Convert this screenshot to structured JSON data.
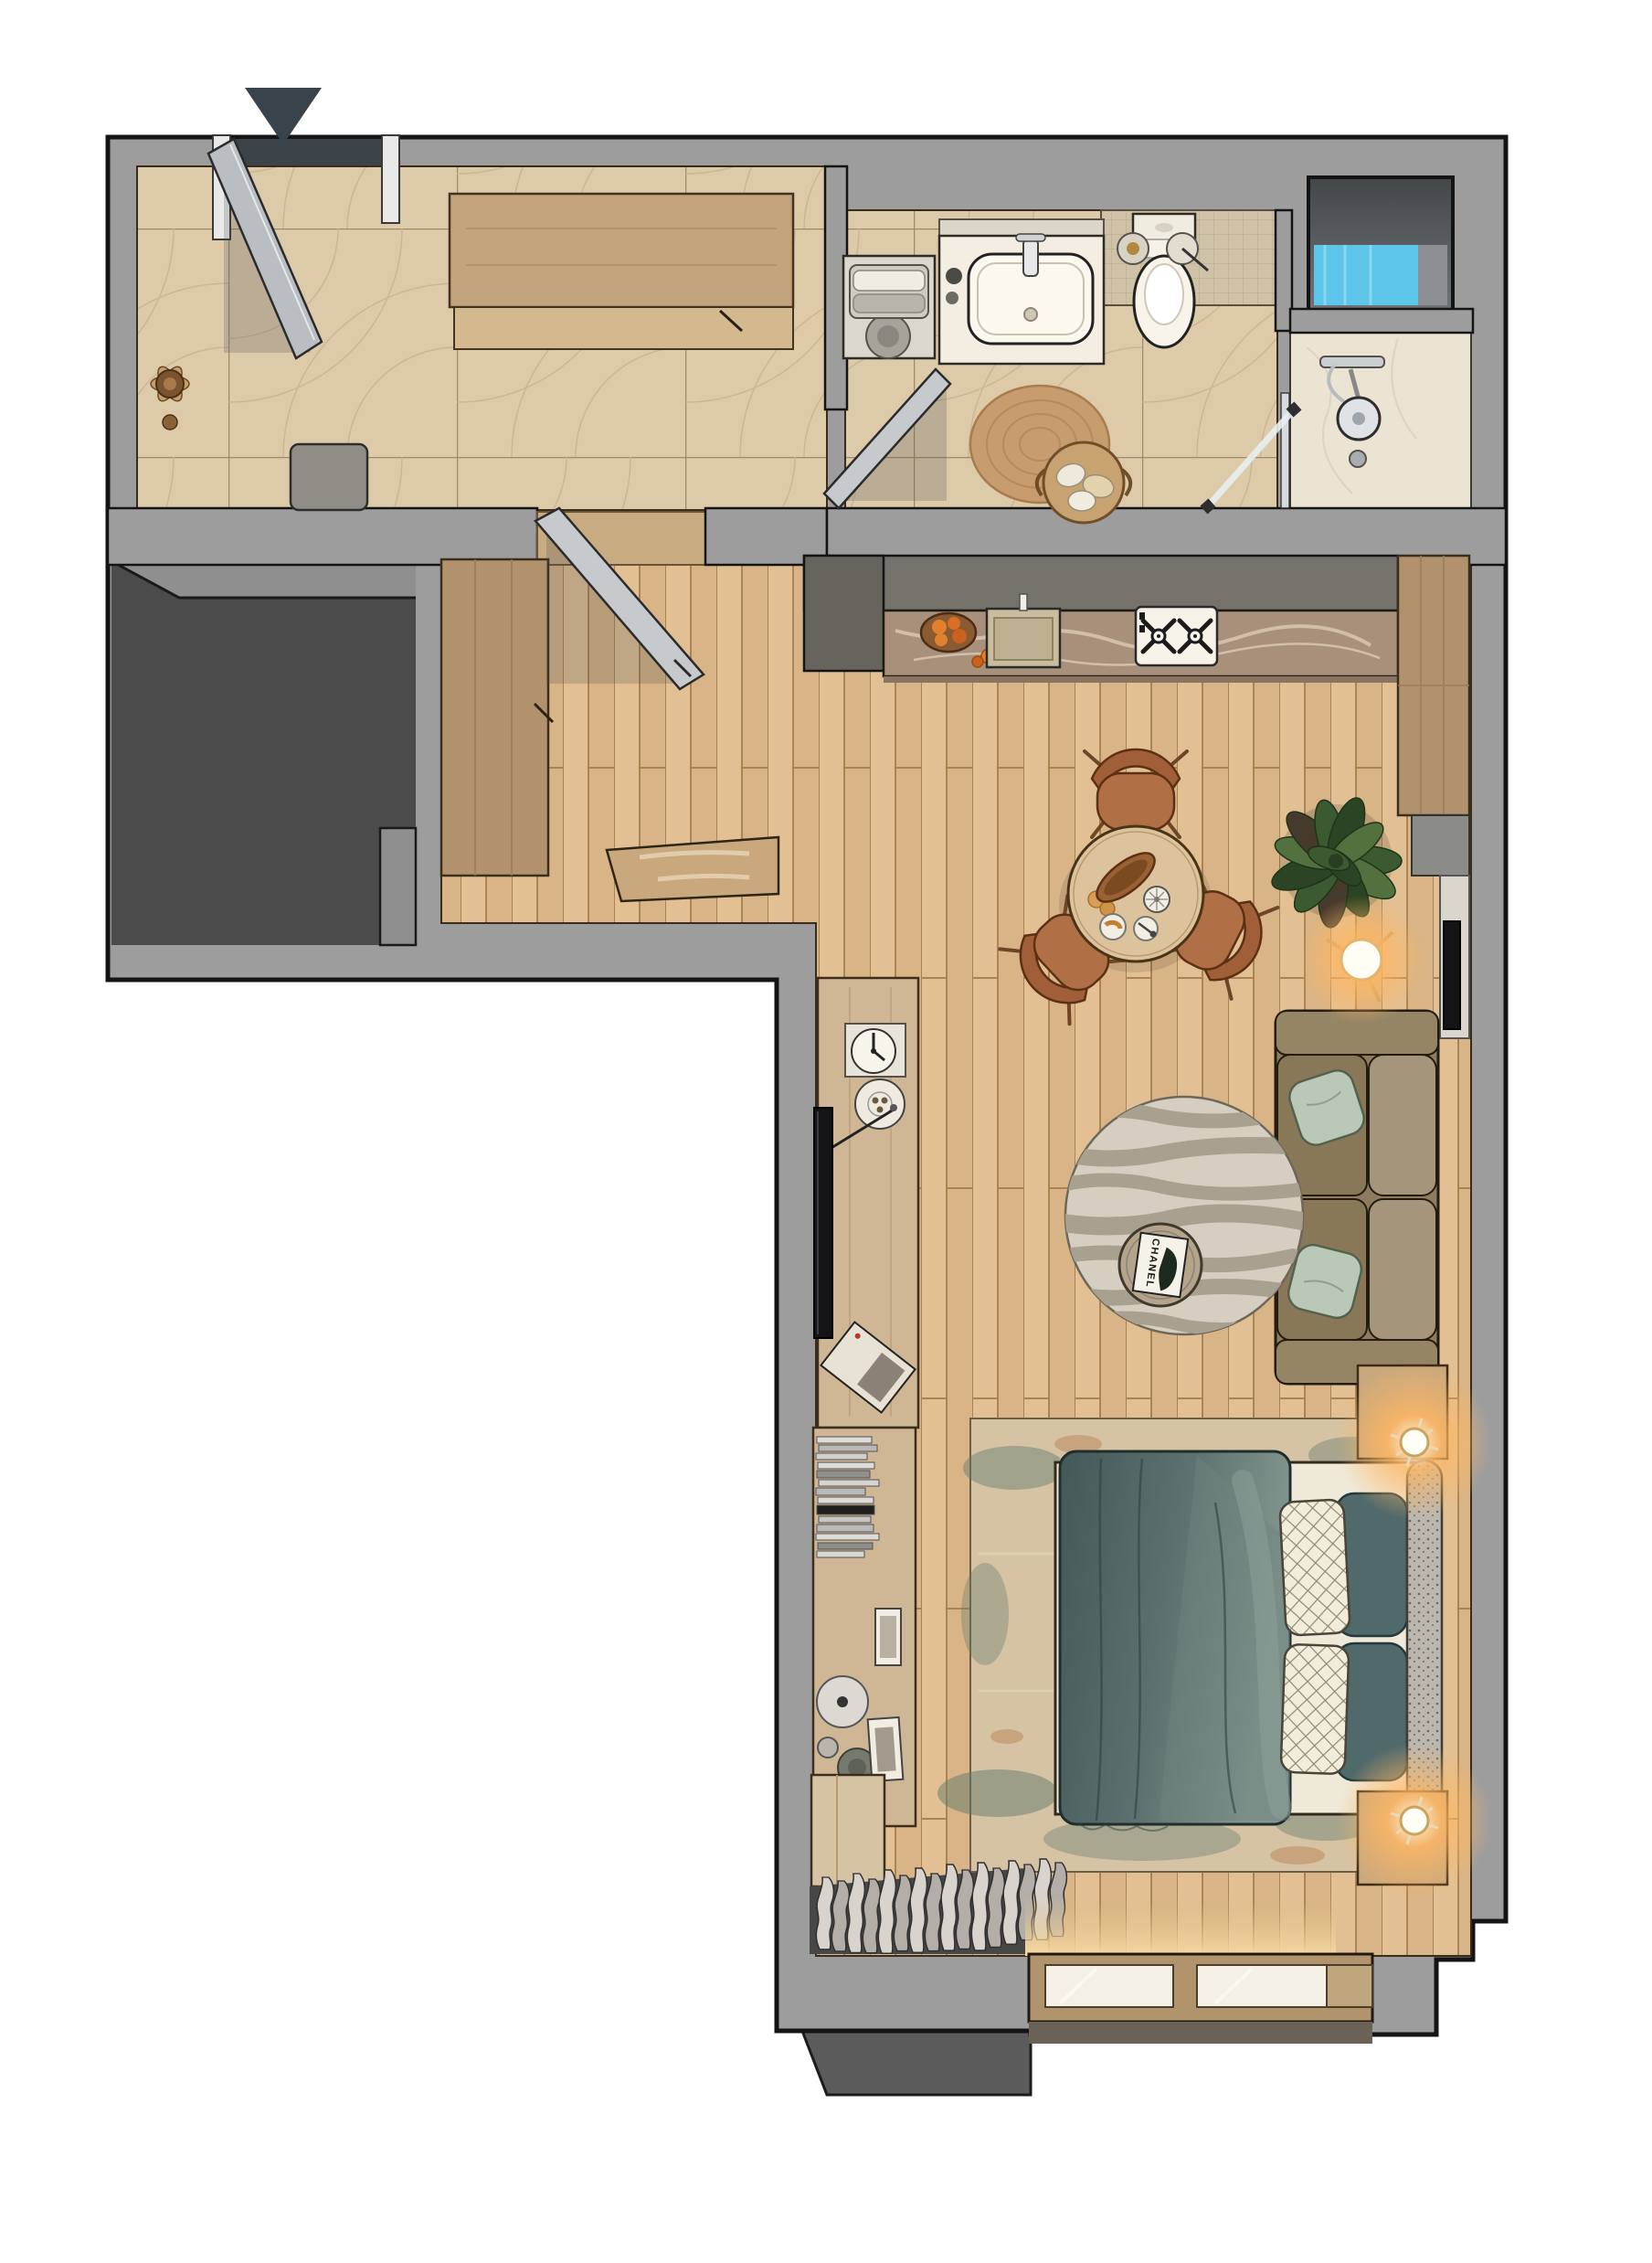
{
  "meta": {
    "view": "top-down 3d rendered floor plan",
    "apartment_shape": "L-shaped studio"
  },
  "entrance": {
    "marker": "entry-direction-arrow"
  },
  "rooms": {
    "entry_hall": {
      "floor": "beige fan-mosaic tile",
      "items": [
        "entry-door",
        "door-frame",
        "wardrobe-cabinet",
        "bench-pouf",
        "wood-wall-decor",
        "hall-door-to-corridor"
      ]
    },
    "bathroom": {
      "floor": "beige fan-mosaic tile",
      "items": [
        "washing-machine",
        "towel-stack",
        "sink-vanity",
        "faucet",
        "toilet",
        "wall-accessories",
        "jute-round-rug",
        "towel-basket",
        "bathroom-door",
        "glass-shower-door"
      ]
    },
    "shower_room": {
      "floor": "cream marble",
      "items": [
        "shower-head",
        "shower-mixer",
        "floor-drain",
        "window-niche-blue-glass"
      ]
    },
    "kitchen": {
      "items": [
        "upper-cabinet-band",
        "stone-countertop",
        "fruit-bowl",
        "counter-sink",
        "gas-hob-two-burners",
        "tall-cabinet-column",
        "wall-niche",
        "wall-shelf",
        "wall-tv-panel",
        "glossy-doormat",
        "corridor-cabinet"
      ]
    },
    "living": {
      "coffee_table_book_title": "CHANEL",
      "items": [
        "round-dining-table",
        "dining-chair",
        "bread-basket",
        "cake-stand",
        "plates",
        "rubber-plant",
        "floor-lamp",
        "sofa",
        "mint-pillows",
        "zebra-round-rug",
        "coffee-table",
        "tv-console",
        "wall-clock",
        "deco-plate",
        "wall-tv",
        "magazine"
      ]
    },
    "bedroom": {
      "items": [
        "bookshelf",
        "book-stack",
        "picture-frames",
        "deco-bowls",
        "double-bed",
        "slate-duvet",
        "quilted-white-pillows",
        "teal-pillows",
        "headboard-bolster",
        "nightstand",
        "sconce-lamp",
        "distressed-rug",
        "corner-cabinet",
        "curtains",
        "window-sill-two-panes"
      ]
    }
  },
  "colors": {
    "wall": "#9d9d9d",
    "darkZone": "#4b4b4b",
    "porch": "#3d4449",
    "arrow": "#39434b",
    "tile": "#ddcaa9",
    "tileLine": "#a18a63",
    "mosaic": "#cfc2a6",
    "marble": "#ece4d3",
    "wood": "#e2c094",
    "woodAlt": "#d8b486",
    "woodLine": "#aa8453",
    "corridorCab": "#b2926d",
    "doorSlab": "#c6cacc",
    "cabinetGrey": "#75726c",
    "cabinetGreyDark": "#67645e",
    "counter": "#a8907a",
    "counterVein": "#ecdfcd",
    "hob": "#f7f3e8",
    "sinkBeige": "#cabc9e",
    "white": "#f3eee1",
    "applianceGrey": "#d9d5cc",
    "jute": "#c79d6f",
    "basket": "#c9a271",
    "glassBlue": "#5ec5ea",
    "nicheDark": "#55595c",
    "tableWood": "#dcc39c",
    "chair": "#b16f45",
    "chairBack": "#a05f38",
    "plant1": "#3b5a31",
    "plant2": "#2b4423",
    "plant3": "#52713f",
    "plantDark": "#463a2c",
    "glowWarm": "#ffb763",
    "sofa": "#8d7c60",
    "sofaCushion": "#a5967b",
    "pillowMint": "#b9c8b7",
    "rugZebraBase": "#d6cec0",
    "rugZebraStripe": "#a9a190",
    "cTable": "#b3a48b",
    "console": "#cfb694",
    "tvBlack": "#141417",
    "bookLight": "#dcdcda",
    "bookMid": "#b9b9b7",
    "bookDark": "#8f8f8d",
    "bookBlack": "#1f1f1f",
    "bedRug": "#d6c3a3",
    "bedRugTeal": "#61796e",
    "bedRugRust": "#b97f52",
    "bedFrame": "#efe9da",
    "duvetA": "#435857",
    "duvetB": "#5d7270",
    "duvetC": "#84968f",
    "pillowWhite": "#f2ecdb",
    "pillowTeal": "#50696a",
    "bolster": "#bab7af",
    "nightstand": "#caa87e",
    "curtain1": "#d8d4cd",
    "curtain2": "#b3afa8",
    "curtainShadow": "#474747",
    "winFrame": "#b2946c",
    "winGlass": "#f4f0e5",
    "floorGlow": "#f4d8a4"
  }
}
